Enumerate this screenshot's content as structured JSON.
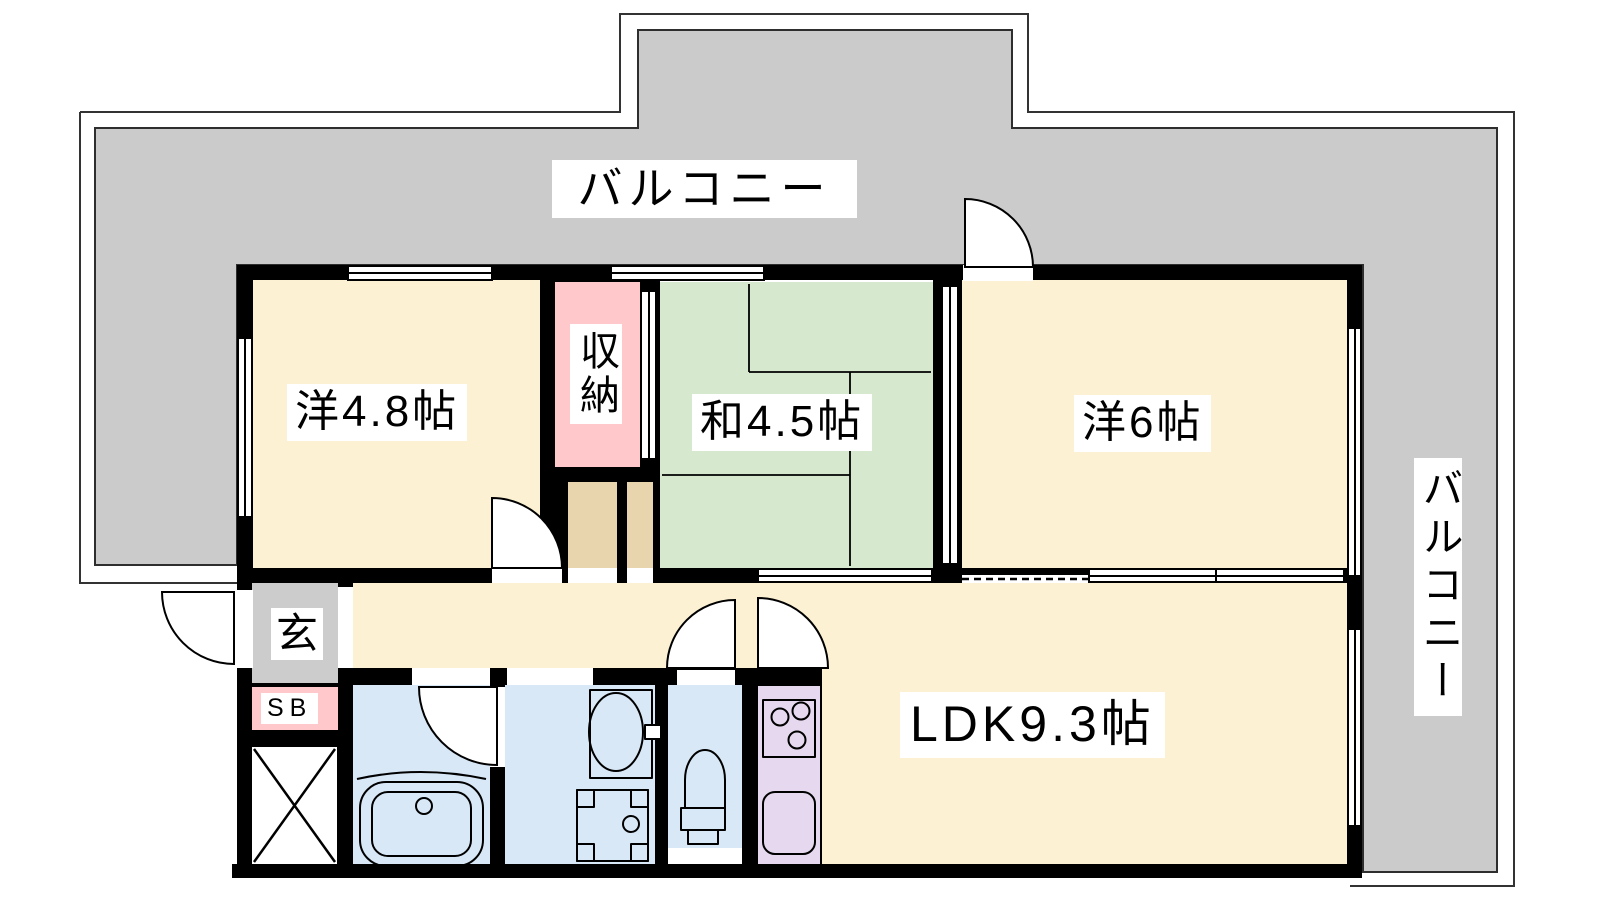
{
  "plan": {
    "kind": "apartment-floor-plan",
    "labels": {
      "balcony_top": "バルコニー",
      "balcony_right": "バルコニー",
      "western_4_8": "洋4.8帖",
      "storage": "収納",
      "japanese_4_5": "和4.5帖",
      "western_6": "洋6帖",
      "entrance": "玄",
      "shoe_box": "SB",
      "ldk": "LDK9.3帖"
    },
    "colors": {
      "balcony": "#CBCBCB",
      "room_floor": "#FCF2D3",
      "tatami": "#D6E9CF",
      "storage_pink": "#FFC8CA",
      "closet_tan": "#E8D5AE",
      "sanitary_blue": "#D8E8F7",
      "kitchen_lavender": "#E6D9EF",
      "entrance_gray": "#CCCCCC",
      "wall": "#000000",
      "label_bg": "#FFFFFF"
    },
    "fixtures": [
      "bathtub",
      "wash-basin",
      "washing-machine-pan",
      "toilet",
      "gas-stove",
      "kitchen-sink",
      "pipe-space-cross"
    ]
  }
}
